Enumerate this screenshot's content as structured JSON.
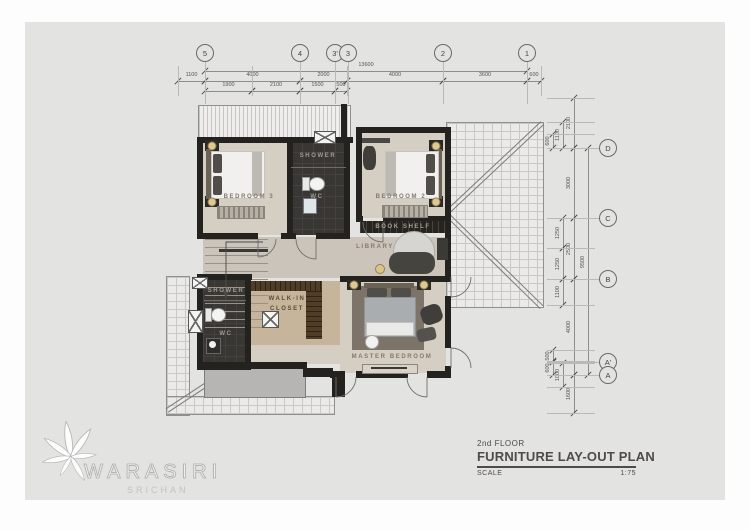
{
  "title_block": {
    "floor_line": "2nd FLOOR",
    "title": "FURNITURE  LAY-OUT  PLAN",
    "scale_label": "SCALE",
    "scale_value": "1:75"
  },
  "logo": {
    "name": "WARASIRI",
    "subname": "SRICHAN"
  },
  "grid": {
    "top": [
      {
        "label": "5",
        "x": 205
      },
      {
        "label": "4",
        "x": 300
      },
      {
        "label": "3'",
        "x": 335
      },
      {
        "label": "3",
        "x": 348
      },
      {
        "label": "2",
        "x": 443
      },
      {
        "label": "1",
        "x": 527
      }
    ],
    "right": [
      {
        "label": "D",
        "y": 148
      },
      {
        "label": "C",
        "y": 218
      },
      {
        "label": "B",
        "y": 279
      },
      {
        "label": "A'",
        "y": 362
      },
      {
        "label": "A",
        "y": 375
      }
    ]
  },
  "dimensions": {
    "top_rows": [
      {
        "y": 71,
        "segs": [
          {
            "x1": 205,
            "x2": 527,
            "label": "13600"
          }
        ]
      },
      {
        "y": 81,
        "segs": [
          {
            "x1": 178,
            "x2": 205,
            "label": "1100"
          },
          {
            "x1": 205,
            "x2": 300,
            "label": "4000"
          },
          {
            "x1": 300,
            "x2": 347,
            "label": "2000"
          },
          {
            "x1": 347,
            "x2": 443,
            "label": "4000"
          },
          {
            "x1": 443,
            "x2": 527,
            "label": "3600"
          },
          {
            "x1": 527,
            "x2": 541,
            "label": "600"
          }
        ]
      },
      {
        "y": 91,
        "segs": [
          {
            "x1": 205,
            "x2": 252,
            "label": "1900"
          },
          {
            "x1": 252,
            "x2": 300,
            "label": "2100"
          },
          {
            "x1": 300,
            "x2": 335,
            "label": "1500"
          },
          {
            "x1": 335,
            "x2": 347,
            "label": "500"
          }
        ]
      }
    ],
    "right_cols": [
      {
        "x": 553,
        "segs": [
          {
            "y1": 134,
            "y2": 148,
            "label": "600"
          },
          {
            "y1": 350,
            "y2": 362,
            "label": "500"
          },
          {
            "y1": 361,
            "y2": 375,
            "label": "600"
          }
        ]
      },
      {
        "x": 563,
        "segs": [
          {
            "y1": 122,
            "y2": 148,
            "label": "1100"
          },
          {
            "y1": 218,
            "y2": 248,
            "label": "1250"
          },
          {
            "y1": 248,
            "y2": 279,
            "label": "1250"
          },
          {
            "y1": 279,
            "y2": 305,
            "label": "1100"
          },
          {
            "y1": 363,
            "y2": 387,
            "label": "1000"
          }
        ]
      },
      {
        "x": 574,
        "segs": [
          {
            "y1": 98,
            "y2": 148,
            "label": "2100"
          },
          {
            "y1": 148,
            "y2": 218,
            "label": "3000"
          },
          {
            "y1": 218,
            "y2": 279,
            "label": "2500"
          },
          {
            "y1": 279,
            "y2": 375,
            "label": "4000"
          },
          {
            "y1": 375,
            "y2": 413,
            "label": "1600"
          }
        ]
      },
      {
        "x": 588,
        "segs": [
          {
            "y1": 148,
            "y2": 375,
            "label": "9500"
          }
        ]
      }
    ]
  },
  "room_labels": [
    {
      "text": "BEDROOM  3",
      "x": 249,
      "y": 197,
      "style": "light"
    },
    {
      "text": "SHOWER",
      "x": 318,
      "y": 156,
      "style": "dark"
    },
    {
      "text": "WC",
      "x": 317,
      "y": 197,
      "style": "dark"
    },
    {
      "text": "BEDROOM  2",
      "x": 401,
      "y": 197,
      "style": "light"
    },
    {
      "text": "BOOK  SHELF",
      "x": 403,
      "y": 227,
      "style": "dark"
    },
    {
      "text": "LIBRARY",
      "x": 375,
      "y": 247,
      "style": "light"
    },
    {
      "text": "WALK-IN",
      "x": 287,
      "y": 299,
      "style": "brown"
    },
    {
      "text": "CLOSET",
      "x": 287,
      "y": 309,
      "style": "brown"
    },
    {
      "text": "SHOWER",
      "x": 226,
      "y": 291,
      "style": "dark"
    },
    {
      "text": "WC",
      "x": 226,
      "y": 334,
      "style": "dark"
    },
    {
      "text": "MASTER  BEDROOM",
      "x": 392,
      "y": 357,
      "style": "light"
    }
  ],
  "lamps": [
    {
      "x": 212,
      "y": 146
    },
    {
      "x": 212,
      "y": 202
    },
    {
      "x": 436,
      "y": 146
    },
    {
      "x": 436,
      "y": 202
    },
    {
      "x": 354,
      "y": 285
    },
    {
      "x": 424,
      "y": 285
    }
  ]
}
